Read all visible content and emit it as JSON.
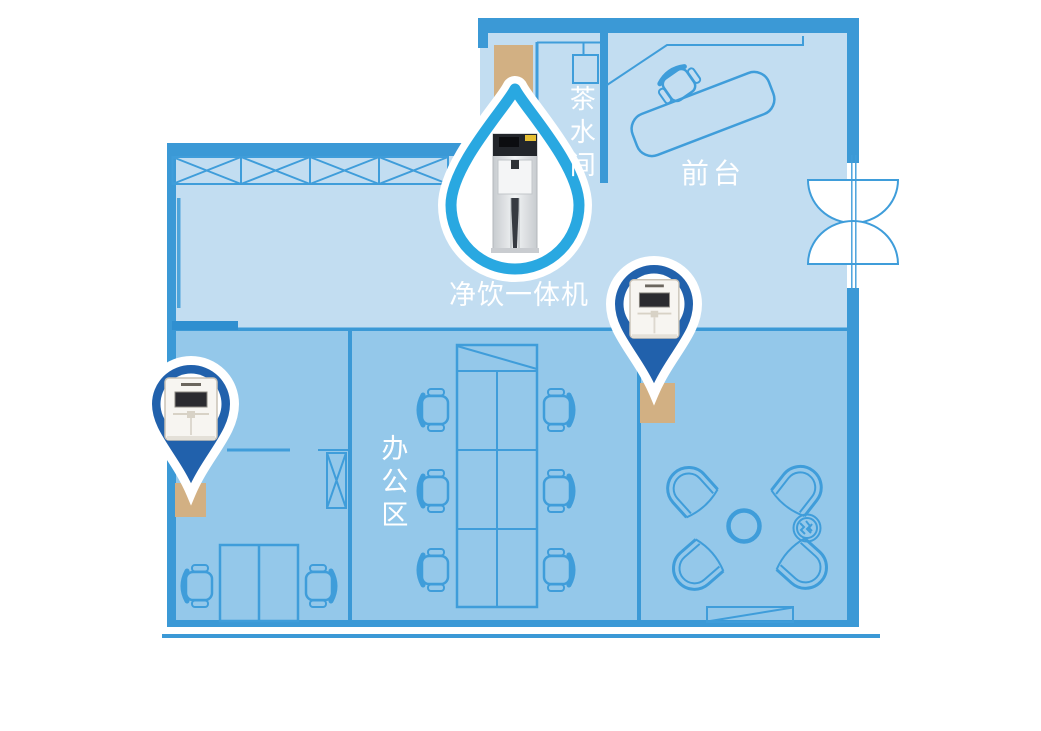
{
  "floor_plan": {
    "rooms": [
      {
        "id": "tea-room",
        "label": "茶水间"
      },
      {
        "id": "reception",
        "label": "前台"
      },
      {
        "id": "office-area",
        "label": "办公区"
      }
    ],
    "device_label": "净饮一体机"
  },
  "markers": [
    {
      "id": "drop-marker",
      "icon": "water-drop",
      "device": "floor-standing-dispenser"
    },
    {
      "id": "pin-marker-right",
      "icon": "map-pin",
      "device": "countertop-dispenser"
    },
    {
      "id": "pin-marker-left",
      "icon": "map-pin",
      "device": "countertop-dispenser"
    }
  ],
  "colors": {
    "upper_fill": "#c2ddf1",
    "lower_fill": "#94c8ea",
    "wall": "#3b99d6",
    "line": "#3f9dda",
    "tan": "#d2b083",
    "pin_blue": "#2161ac",
    "drop_blue": "#29a8e1",
    "label": "#ffffff"
  }
}
